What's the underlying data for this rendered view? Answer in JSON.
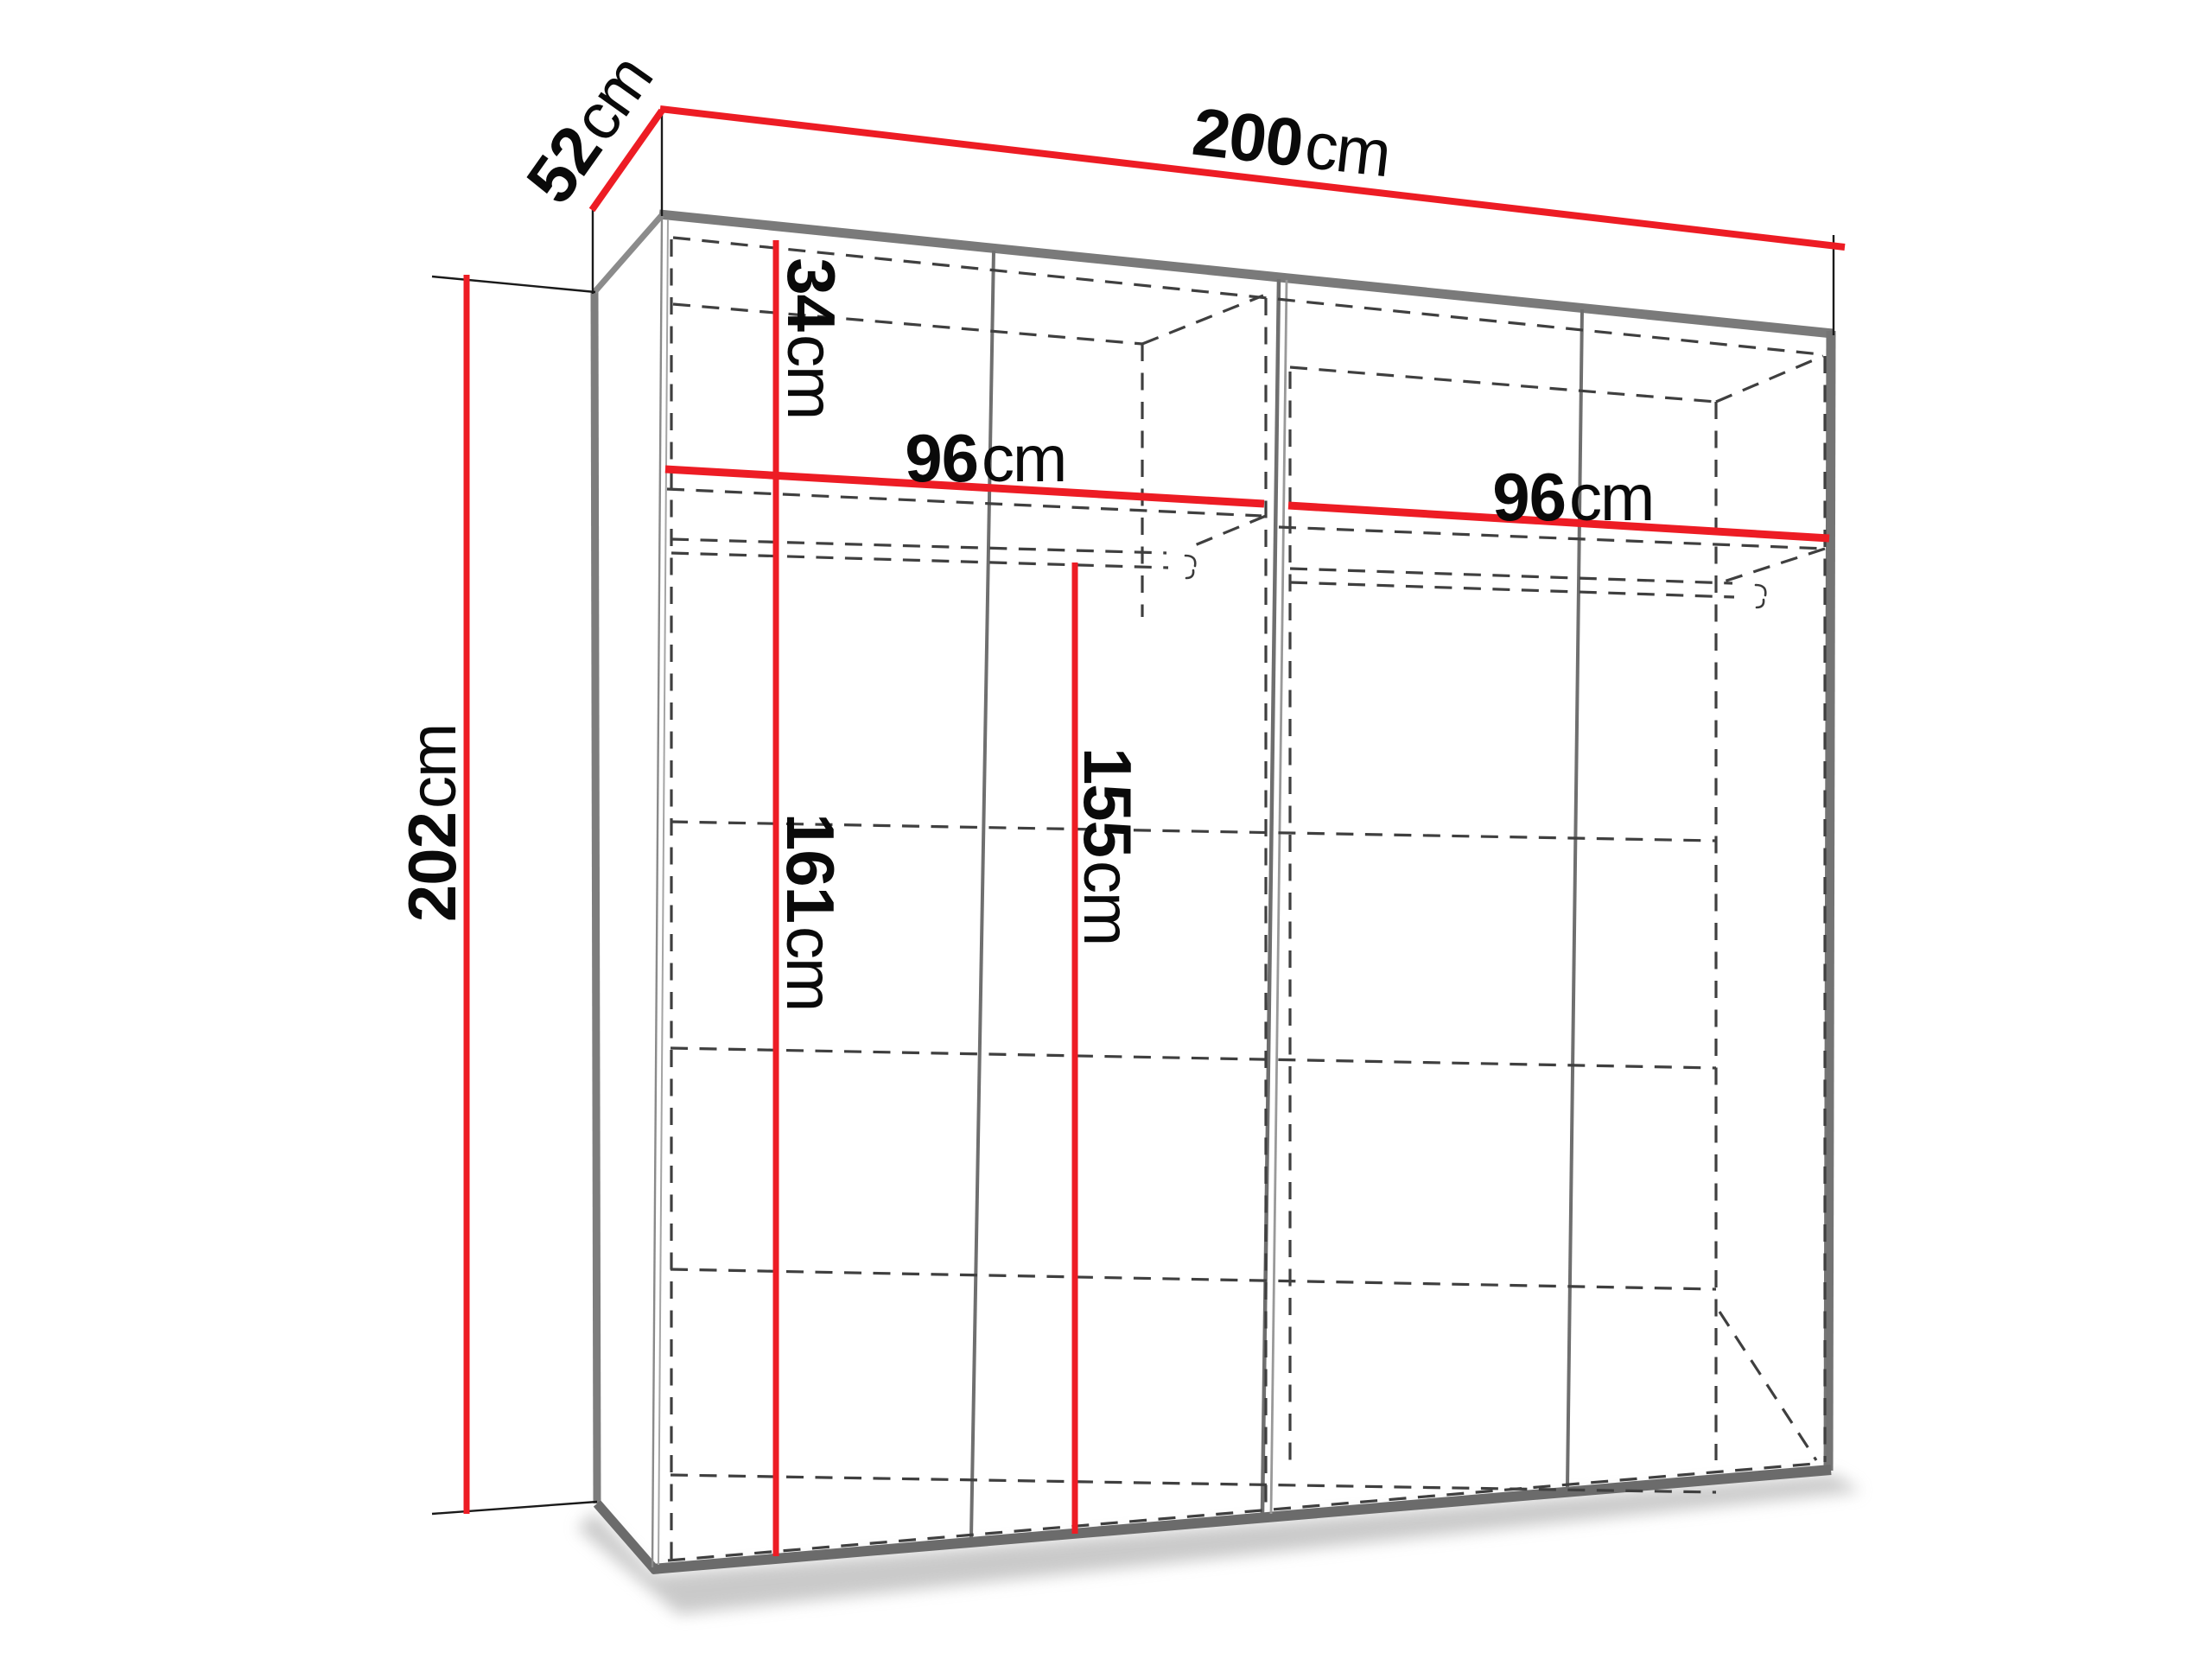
{
  "diagram": {
    "type": "furniture-dimension-diagram",
    "subject": "wardrobe interior dimensions, perspective line drawing",
    "colors": {
      "dimension_line": "#ed1c24",
      "frame_gray": "#747474",
      "hidden_line_gray": "#3f3f3f",
      "label_text": "#0a0a0a",
      "background": "#ffffff"
    },
    "dimensions": {
      "width": {
        "value": "200",
        "unit": "cm"
      },
      "depth": {
        "value": "52",
        "unit": "cm"
      },
      "height": {
        "value": "202",
        "unit": "cm"
      },
      "top_shelf": {
        "value": "34",
        "unit": "cm"
      },
      "left_section": {
        "value": "96",
        "unit": "cm"
      },
      "right_section": {
        "value": "96",
        "unit": "cm"
      },
      "left_hanging": {
        "value": "161",
        "unit": "cm"
      },
      "rail_height": {
        "value": "155",
        "unit": "cm"
      }
    }
  }
}
